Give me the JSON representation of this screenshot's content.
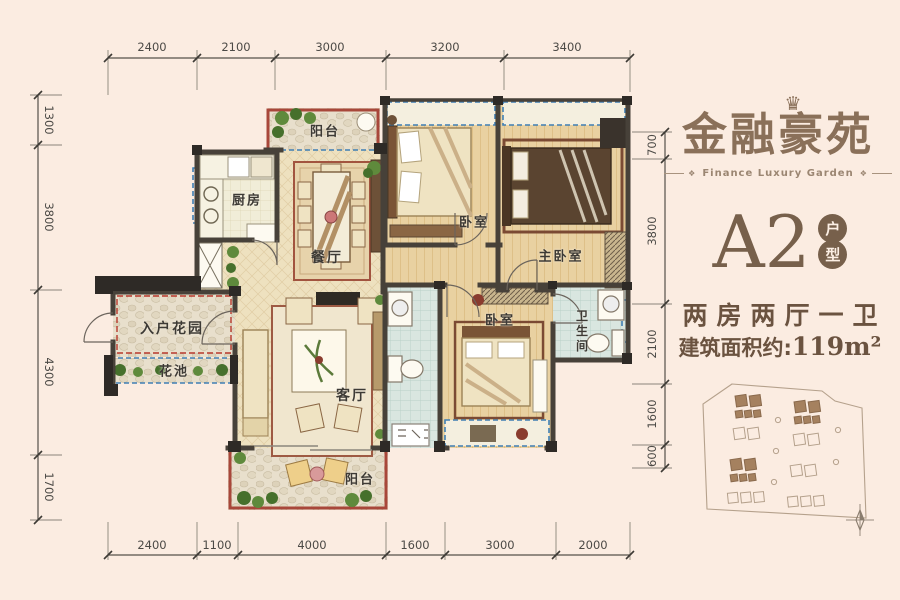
{
  "brand": {
    "name": "金融豪苑",
    "tagline": "Finance Luxury Garden",
    "crown_icon": "♛",
    "ornament_icon": "❖"
  },
  "unit": {
    "code": "A2",
    "badge_top": "户",
    "badge_bottom": "型",
    "layout": "两房两厅一卫",
    "area_label": "建筑面积约:",
    "area_value": "119m²"
  },
  "rooms": {
    "balcony_top": "阳台",
    "kitchen": "厨房",
    "dining": "餐厅",
    "bedroom_top": "卧室",
    "master_bedroom": "主卧室",
    "entry_garden": "入户花园",
    "flower_bed": "花池",
    "living": "客厅",
    "bedroom_bottom": "卧室",
    "bathroom": "卫生间",
    "balcony_bottom": "阳台"
  },
  "dimensions": {
    "top": [
      "2400",
      "2100",
      "3000",
      "3200",
      "3400"
    ],
    "bottom": [
      "2400",
      "1100",
      "4000",
      "1600",
      "3000",
      "2000"
    ],
    "left": [
      "1300",
      "3800",
      "4300",
      "1700"
    ],
    "right": [
      "700",
      "3800",
      "2100",
      "1600",
      "600"
    ]
  },
  "colors": {
    "background": "#fbece1",
    "accent_brown": "#8a7059",
    "text_brown": "#6b5340",
    "wall": "#474139",
    "window_blue": "#3f7fb4",
    "railing_red": "#a8473a"
  }
}
